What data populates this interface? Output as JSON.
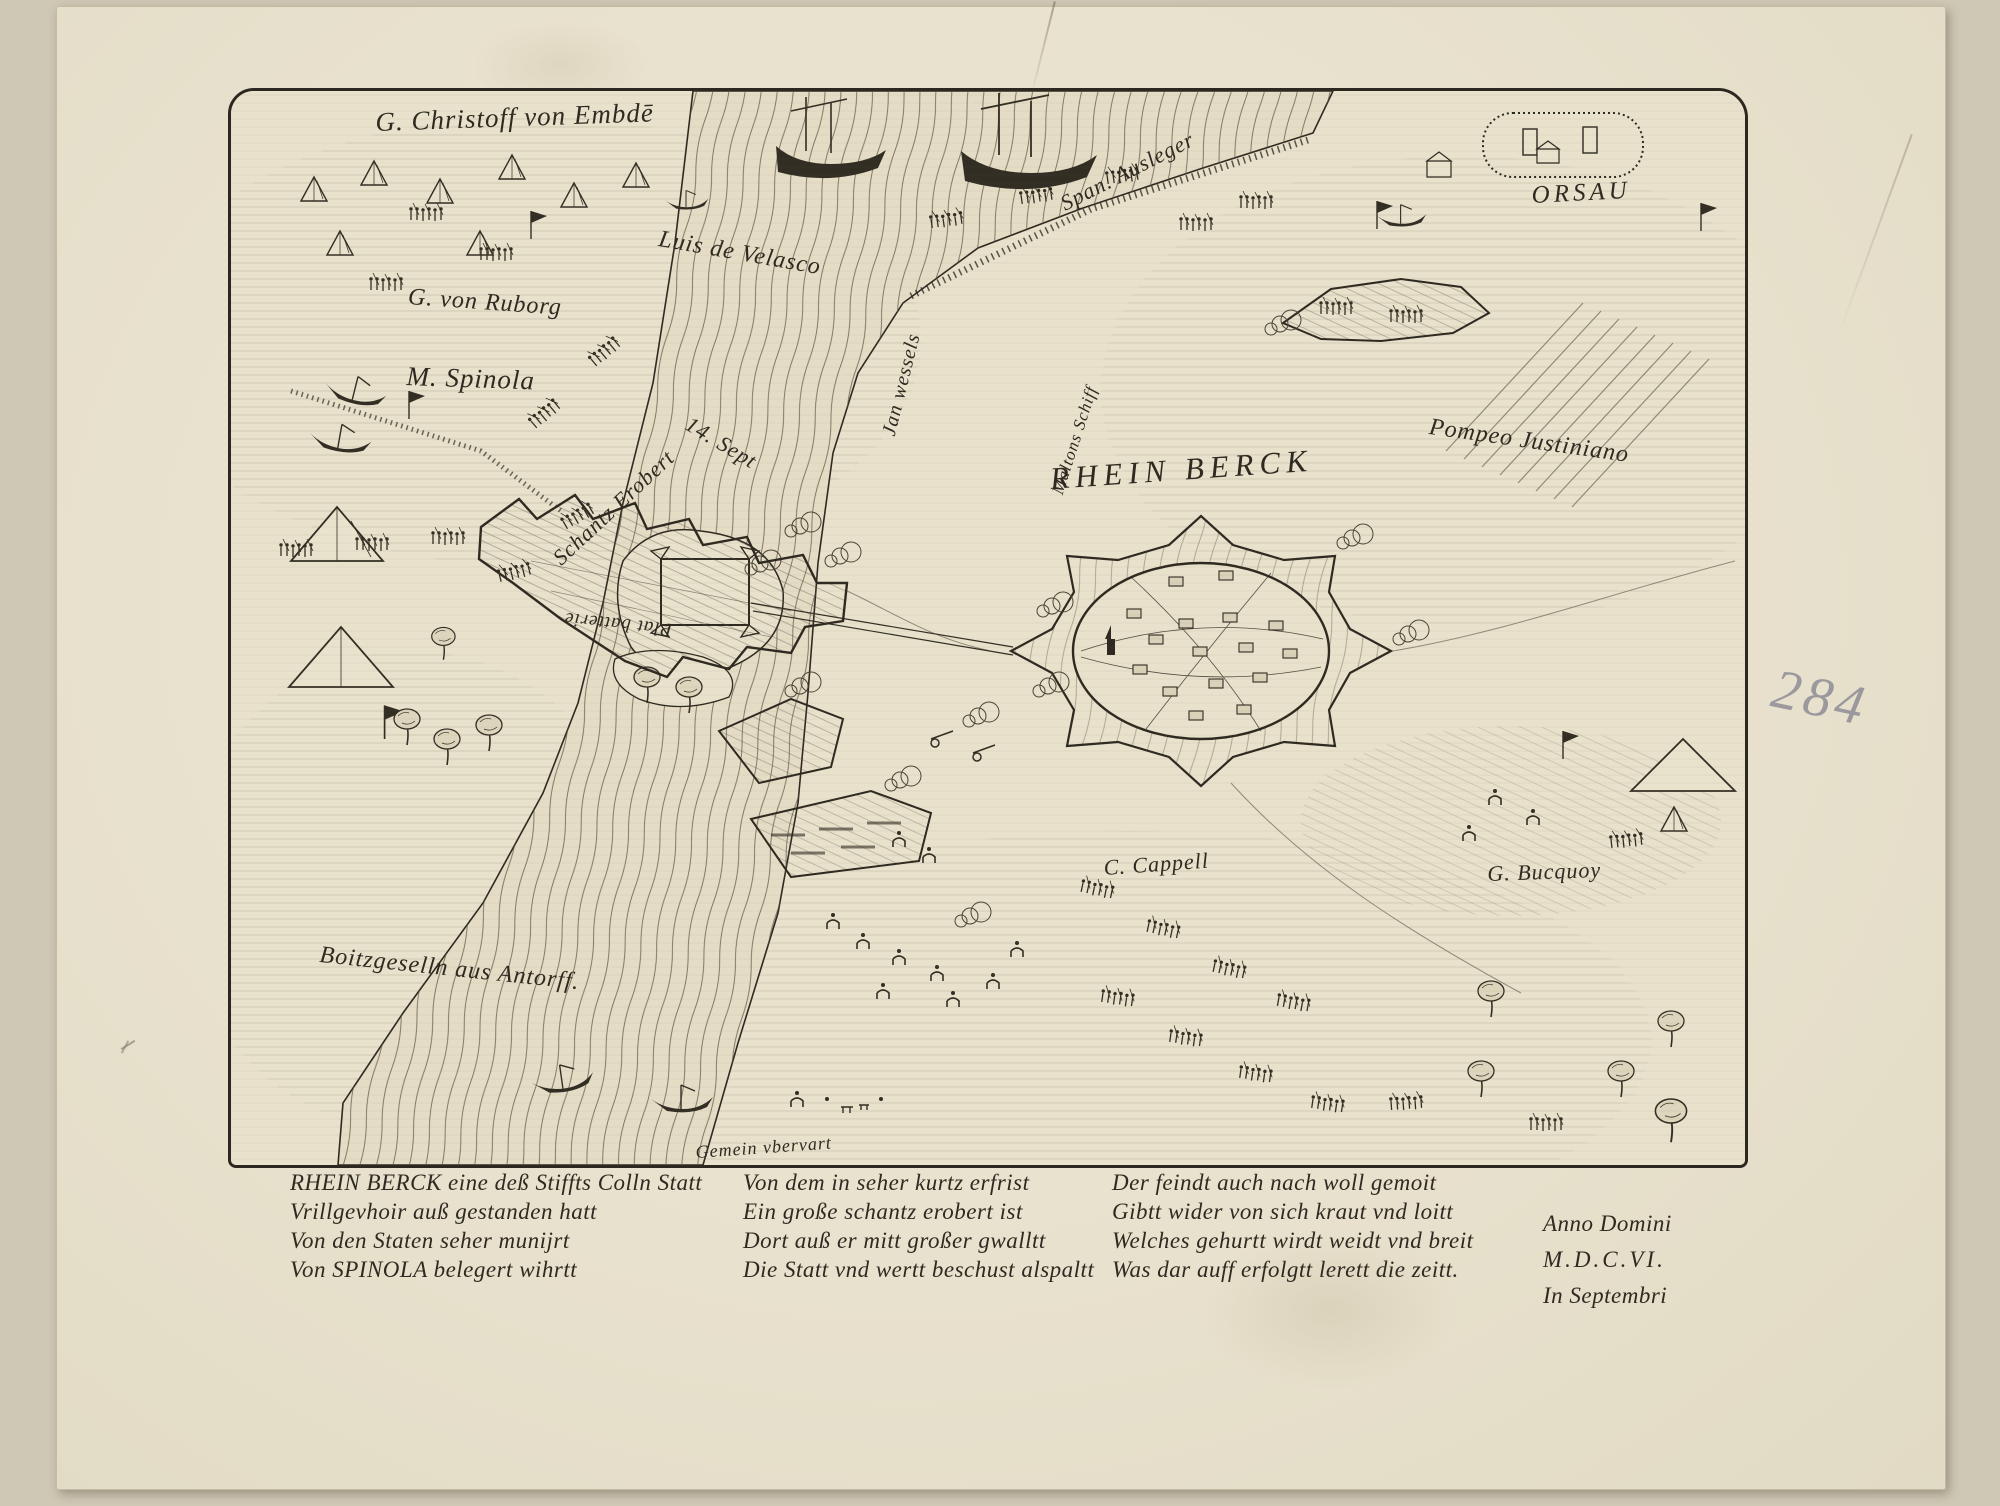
{
  "artwork": {
    "type_note": "engraved siege map",
    "plate_title": "RHEIN BERCK"
  },
  "labels": {
    "embden": "G. Christoff von Embdē",
    "span_ausleger": "Span. Ausleger",
    "orsau": "ORSAU",
    "velasco": "Luis de Velasco",
    "ruborg": "G. von Ruborg",
    "spinola": "M. Spinola",
    "jan_wessels": "Jan wessels",
    "maltons_schiff": "Maltons Schiff",
    "sept": "14. Sept",
    "schantz": "Schantz Erobert",
    "pompeo": "Pompeo Justiniano",
    "rhein_berck": "RHEIN BERCK",
    "plat": "Plat batterie",
    "cappell": "C. Cappell",
    "bucquoy": "G. Bucquoy",
    "antorff": "Boitzgeselln aus Antorff.",
    "gemein": "Gemein vbervart"
  },
  "caption": {
    "col1": [
      "RHEIN BERCK eine deß Stiffts Colln Statt",
      "Vrillgevhoir auß gestanden hatt",
      "Von den Staten seher munijrt",
      "Von SPINOLA belegert wihrtt"
    ],
    "col2": [
      "Von dem in seher kurtz erfrist",
      "Ein große schantz erobert ist",
      "Dort auß er mitt großer gwalltt",
      "Die Statt vnd wertt beschust alspaltt"
    ],
    "col3": [
      "Der feindt auch nach woll gemoit",
      "Gibtt wider von sich kraut vnd loitt",
      "Welches gehurtt wirdt weidt vnd breit",
      "Was dar auff erfolgtt lerett die zeitt."
    ],
    "col4": [
      "Anno Domini",
      "M.D.C.VI.",
      "In Septembri"
    ]
  },
  "annotations": {
    "pencil_number": "284"
  },
  "colors": {
    "paper": "#e9e2cf",
    "map_paper": "#e8e1cb",
    "ink": "#2e2a21",
    "pencil": "#8e8c96"
  }
}
